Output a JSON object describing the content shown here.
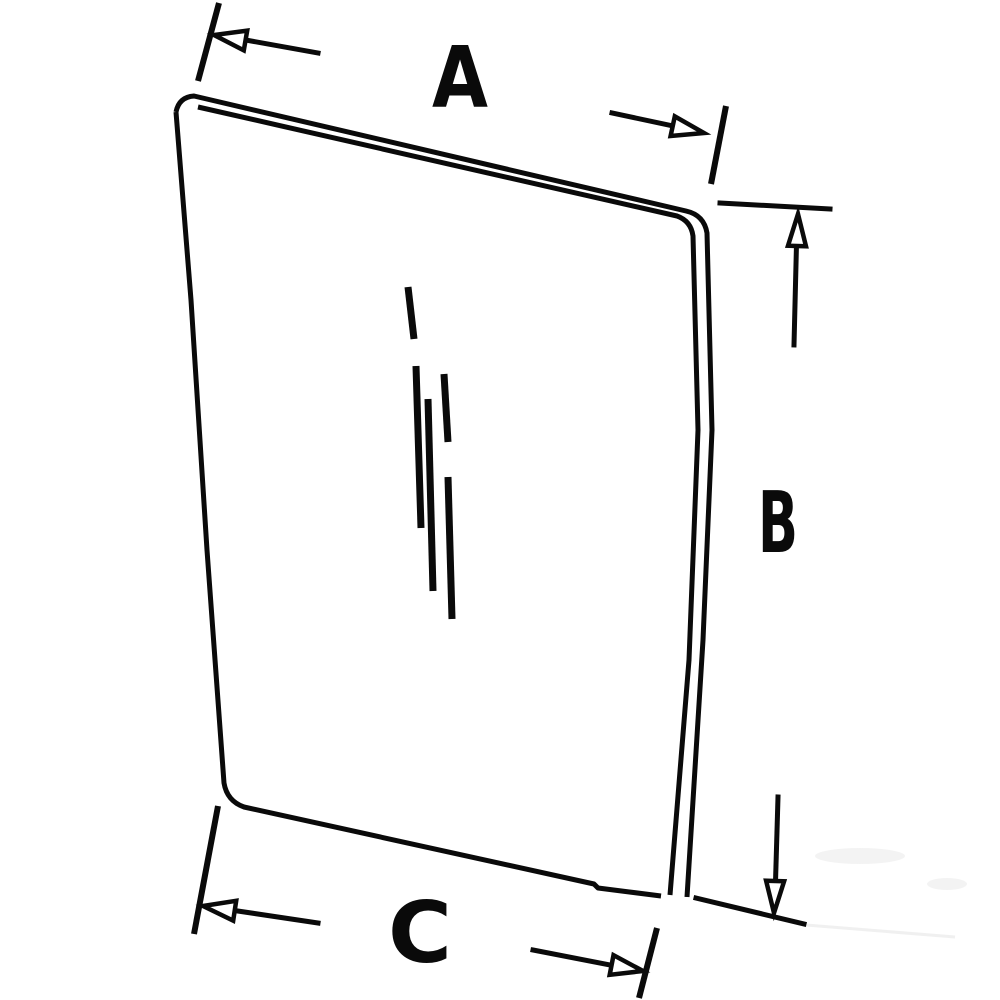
{
  "figure": {
    "description": "Technical line drawing of a curved glass panel (window pane) with rounded corners, shown in slight perspective, annotated with three dimension callouts",
    "background_color": "#ffffff",
    "line_color": "#0a0a0a",
    "dimension_labels": {
      "a": "A",
      "b": "B",
      "c": "C"
    },
    "dimensions": [
      {
        "label": "A",
        "position": "top"
      },
      {
        "label": "B",
        "position": "right"
      },
      {
        "label": "C",
        "position": "bottom"
      }
    ]
  }
}
